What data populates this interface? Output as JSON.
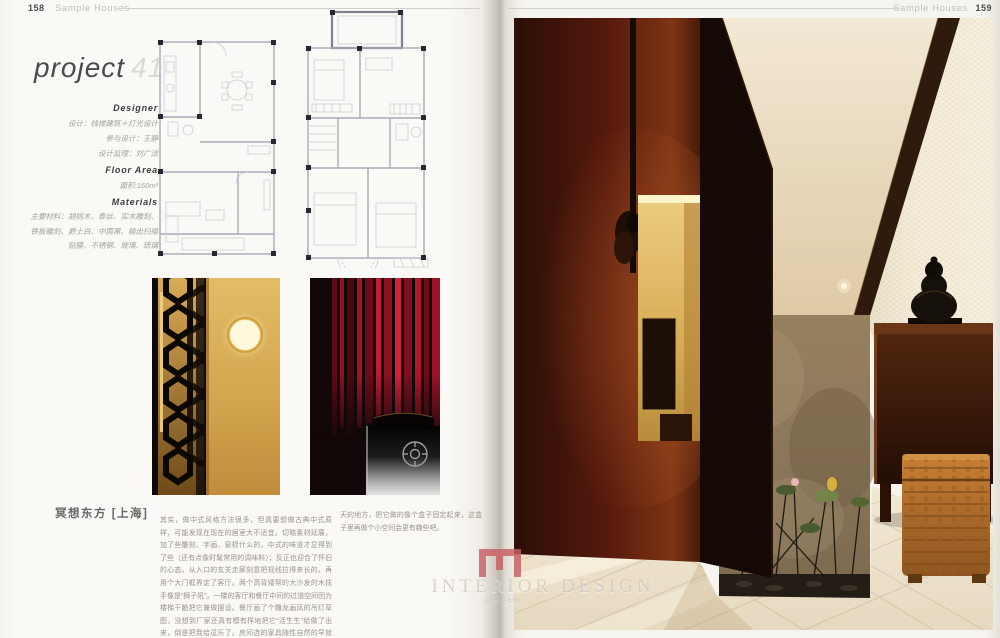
{
  "left_page": {
    "page_number": "158",
    "section": "Sample Houses",
    "project": {
      "word": "project",
      "number": "41"
    },
    "info": {
      "designer_label": "Designer",
      "design_line": "设计：栈楼建筑＋灯光设计",
      "assist_line": "参与设计：王静",
      "supervise_line": "设计监理：刘广洁",
      "floor_area_label": "Floor Area",
      "floor_area_value": "面积:160m²",
      "materials_label": "Materials",
      "materials_text": "主要材料：胡桃木、泰丝、实木雕刻、铁板雕刻、爵士白、中国黑、输出扫描贴膜、不锈钢、玻璃、琉璃"
    },
    "article": {
      "title": "冥想东方 [上海]",
      "column1": "其实，做中式风格方法很多，但真要想做古典中式原样，可能发现在现在的居室大不适宜。切略素材延展，加了些雕刻、字画、窗棂什么的，中式的味道才显得到了些（还有点像时髦常用的调味料）；反正也迎合了怀旧的心态。从入口的玄关走廊刻意把视线拉得来长的，再用个大门框界定了客厅。两个高背矮帮的大沙发的木扶手像是“狮子吼”。一楼的客厅和餐厅中间的过道空间因为楼梯干脆把它兼做摆设。餐厅画了个雕龙画凤的吊灯草图，没想到厂家还真有模有样地把它“活生生”给做了出来，倒是把我给逗乐了。房间选的家具随性自然的早就让中式去掉，让土壤里加了个老露",
      "column2": "天的地方，把它做的像个盒子固定起来，这盒子里再做个小空间会更有趣些吧。"
    }
  },
  "right_page": {
    "page_number": "159",
    "section": "Sample Houses"
  },
  "watermark": {
    "title": "INTERIOR DESIGN",
    "subtitle": "@mt-bbs",
    "logo_color": "#c85f66"
  },
  "colors": {
    "lattice_glow": "#d9a94f",
    "curtain_red": "#b01228",
    "wood_dark": "#3a1d0e",
    "marble": "#ece2cd"
  }
}
